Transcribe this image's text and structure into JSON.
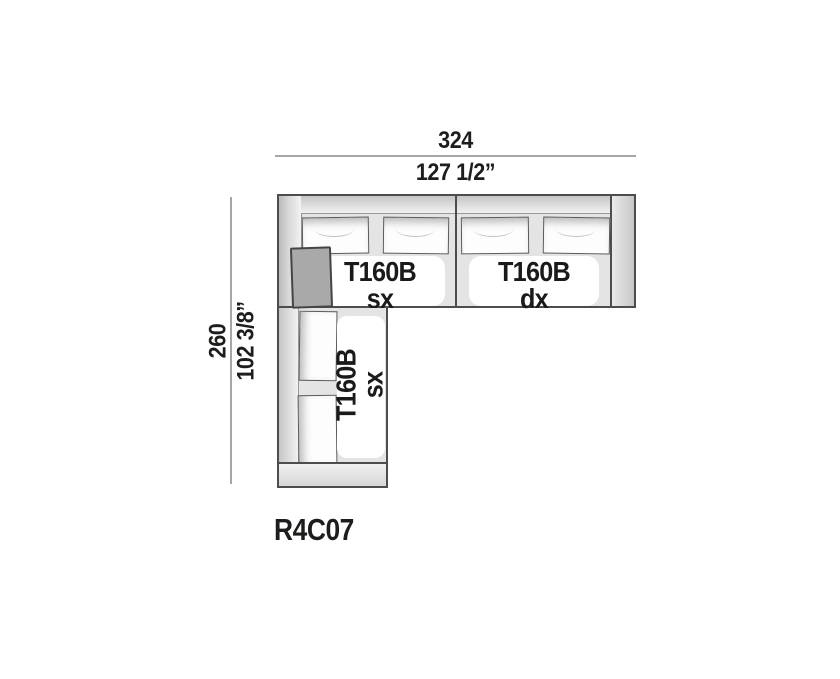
{
  "diagram": {
    "model_code": "R4C07",
    "dimensions": {
      "width_cm": "324",
      "width_in": "127 1/2”",
      "depth_cm": "260",
      "depth_in": "102 3/8”"
    },
    "modules": {
      "top_left": {
        "line1": "T160B",
        "line2": "sx"
      },
      "top_right": {
        "line1": "T160B",
        "line2": "dx"
      },
      "side": {
        "line1": "T160B",
        "line2": "sx"
      }
    },
    "colors": {
      "dimension_line": "#a6a6a6",
      "outline": "#4d4d4d",
      "module_background": "#e4e4e4",
      "accent_pillow": "#a9a9a9",
      "text": "#1d1d1b"
    }
  }
}
